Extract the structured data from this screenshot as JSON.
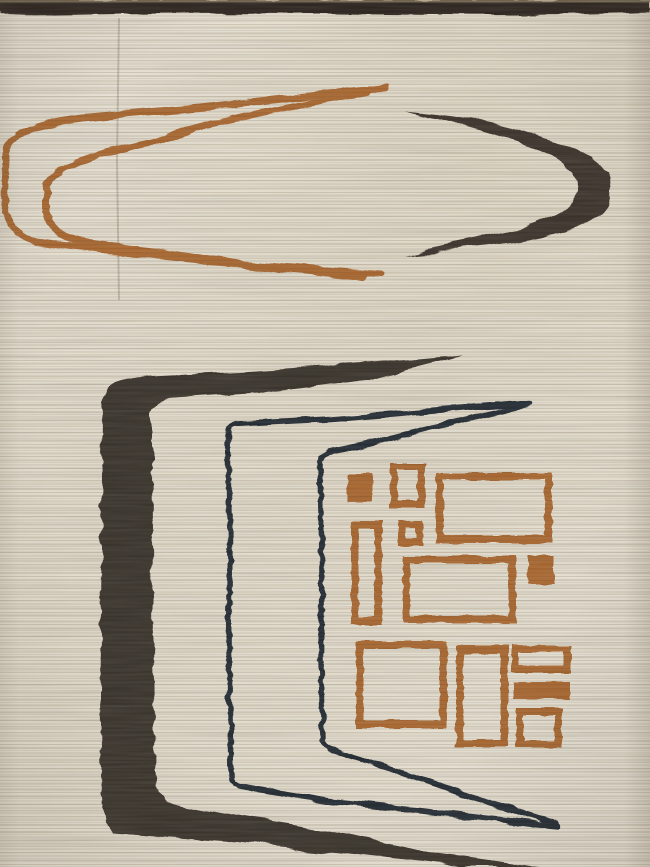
{
  "canvas": {
    "width": 650,
    "height": 867
  },
  "palette": {
    "field_cream": "#e8e2d4",
    "striation": "#cdc5b2",
    "selvedge_dark_brown": "#2b241a",
    "selvedge_highlight": "#9a8c6e",
    "motif_dark_umber": "#38302a",
    "motif_navy_ink": "#212a31",
    "motif_rust": "#a8662f",
    "crease_shadow": "#6e604a"
  },
  "rug": {
    "selvedge_band": {
      "d": "M0,0 L650,0 L650,12 Q520,16 390,14 Q200,12 60,15 Q20,16 0,14 Z",
      "fill": "#2b241a"
    },
    "selvedge_highlight": {
      "x": 0,
      "y": 0,
      "w": 650,
      "h": 2.5,
      "fill": "rgba(170,155,120,0.55)"
    },
    "crease": {
      "d": "M119,18 L117,160 L119,300",
      "stroke": "rgba(110,98,78,0.30)",
      "width": 2
    },
    "shapes": [
      {
        "name": "motif-orange-open-loop-outer",
        "d": "M386,88 L300,97 L200,108 L82,118 Q10,127 6,152 L5,205 Q7,231 36,242 L110,251 L200,261 L300,268 L381,274",
        "fill": "none",
        "stroke": "#a8662f",
        "width": 7,
        "texture": "line"
      },
      {
        "name": "motif-orange-open-loop-inner",
        "d": "M368,92 L290,107 L205,125 L152,142 Q50,163 46,188 L46,212 Q50,236 88,243 L160,252 L255,266 L364,277",
        "fill": "none",
        "stroke": "#a8662f",
        "width": 7,
        "texture": "line"
      },
      {
        "name": "motif-dark-boomerang",
        "d": "M406,111 C460,116 525,127 566,146 C600,161 612,172 611,191 C610,213 592,226 558,233 C515,243 460,249 404,254 C455,242 510,234 543,221 C570,210 578,199 577,186 C576,170 560,158 532,148 C498,135 452,122 406,111 Z",
        "fill": "#3a332b",
        "stroke": "none",
        "width": 0,
        "texture": "heavy"
      },
      {
        "name": "motif-dark-bracket",
        "d": "M464,355 L360,364 L240,372 L140,377 Q104,380 102,400 L101,550 L100,700 L102,795 Q103,820 113,833 L230,842 L340,853 L455,866 L460,867 L540,867 L430,852 L310,827 L200,809 L168,801 Q156,796 155,772 L153,600 L152,470 L152,412 Q152,401 168,399 L260,393 L370,379 L464,355 Z",
        "fill": "#38302a",
        "stroke": "none",
        "width": 0,
        "texture": "heavy"
      },
      {
        "name": "motif-navy-bracket-outer",
        "d": "M529,403 L430,411 L330,419 L236,424 Q228,427 228,437 L230,540 L229,650 L231,776 Q231,784 240,786 L330,801 L440,813 L558,826",
        "fill": "none",
        "stroke": "#212a31",
        "width": 5.5,
        "texture": "line"
      },
      {
        "name": "motif-navy-bracket-inner",
        "d": "M527,405 L455,422 L385,440 L328,452 Q320,456 320,466 L322,560 L321,660 L323,739 Q323,747 332,751 L410,775 L490,803 L556,823",
        "fill": "none",
        "stroke": "#212a31",
        "width": 5.5,
        "texture": "line"
      }
    ],
    "rust_rectangles": [
      {
        "name": "rust-square-small-filled-top",
        "x": 347,
        "y": 474,
        "w": 26,
        "h": 29,
        "style": "filled"
      },
      {
        "name": "rust-rect-portrait-top",
        "x": 390,
        "y": 463,
        "w": 35,
        "h": 45,
        "style": "outlined"
      },
      {
        "name": "rust-rect-large-top",
        "x": 436,
        "y": 473,
        "w": 116,
        "h": 70,
        "style": "outlined"
      },
      {
        "name": "rust-square-small-mid",
        "x": 398,
        "y": 520,
        "w": 25,
        "h": 26,
        "style": "outlined"
      },
      {
        "name": "rust-rect-tall-left",
        "x": 351,
        "y": 521,
        "w": 31,
        "h": 104,
        "style": "outlined"
      },
      {
        "name": "rust-rect-medium-mid",
        "x": 403,
        "y": 556,
        "w": 113,
        "h": 67,
        "style": "outlined"
      },
      {
        "name": "rust-square-filled-right",
        "x": 528,
        "y": 556,
        "w": 26,
        "h": 28,
        "style": "filled"
      },
      {
        "name": "rust-square-large-bottom",
        "x": 356,
        "y": 641,
        "w": 91,
        "h": 87,
        "style": "outlined"
      },
      {
        "name": "rust-rect-tall-bottom",
        "x": 456,
        "y": 646,
        "w": 52,
        "h": 101,
        "style": "outlined"
      },
      {
        "name": "rust-rect-wide-right",
        "x": 511,
        "y": 645,
        "w": 60,
        "h": 28,
        "style": "outlined"
      },
      {
        "name": "rust-bar-filled-right",
        "x": 513,
        "y": 682,
        "w": 57,
        "h": 17,
        "style": "filled"
      },
      {
        "name": "rust-square-small-bottomright",
        "x": 516,
        "y": 708,
        "w": 46,
        "h": 40,
        "style": "outlined"
      }
    ],
    "rect_stroke_width": 7.5,
    "rect_color": "#a8662f"
  }
}
